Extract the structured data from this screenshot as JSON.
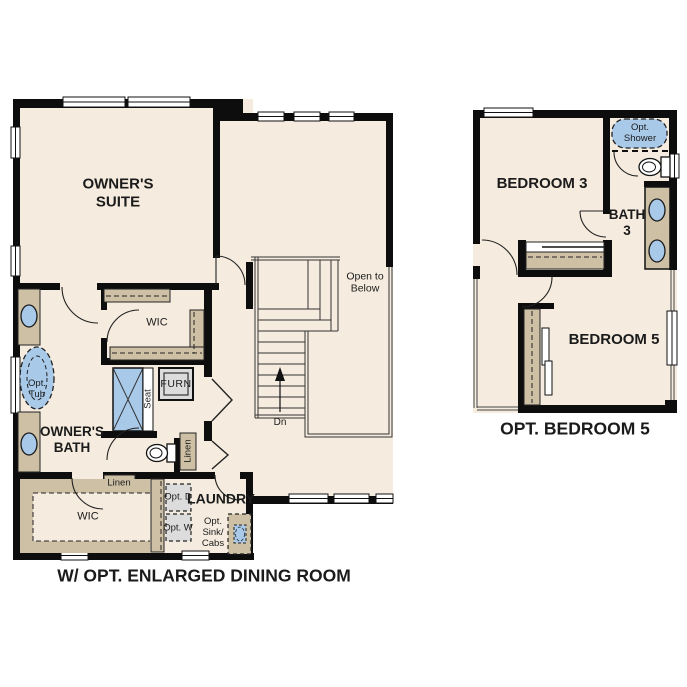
{
  "title": "Second floor options floor plan",
  "colors": {
    "floor": "#f5ecdf",
    "wall": "#0d0d0d",
    "tan": "#cec0a5",
    "blue": "#a9c9e9",
    "gray": "#dcdcdc",
    "line": "#333333"
  },
  "left_plan": {
    "caption": "W/ OPT. ENLARGED DINING ROOM",
    "labels": {
      "owners_suite": "OWNER'S SUITE",
      "wic_upper": "WIC",
      "wic_lower": "WIC",
      "owners_bath": "OWNER'S BATH",
      "laundry": "LAUNDRY",
      "furnace": "FURN",
      "seat": "Seat",
      "linen_hall": "Linen",
      "linen_closet": "Linen",
      "opt_tub": "Opt. Tub",
      "opt_dryer": "Opt. D",
      "opt_washer": "Opt. W",
      "opt_sink_cabs": "Opt. Sink/ Cabs",
      "open_to_below": "Open to Below",
      "stair_direction": "Dn"
    }
  },
  "right_plan": {
    "caption": "OPT. BEDROOM 5",
    "labels": {
      "bedroom3": "BEDROOM 3",
      "bath3": "BATH 3",
      "bedroom5": "BEDROOM 5",
      "opt_shower": "Opt. Shower"
    }
  }
}
